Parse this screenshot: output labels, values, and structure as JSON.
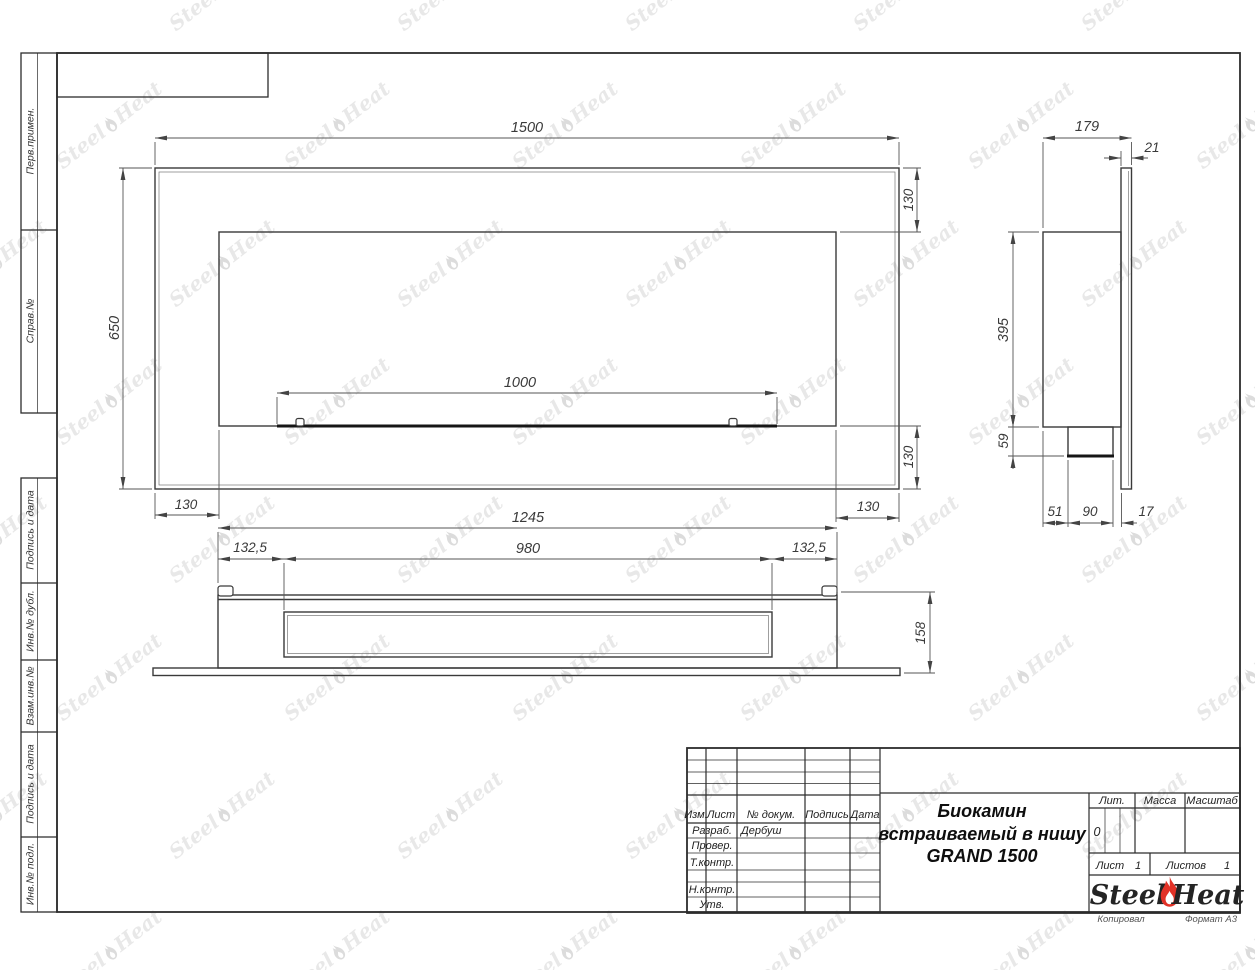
{
  "watermark": {
    "steel": "Steel",
    "heat": "Heat"
  },
  "stamps": {
    "left_column": [
      "Перв.примен.",
      "Справ.№",
      "Подпись и дата",
      "Инв.№ дубл.",
      "Взам.инв.№",
      "Подпись и дата",
      "Инв.№ подл."
    ]
  },
  "views": {
    "front": {
      "width": "1500",
      "height": "650",
      "offset_top": "130",
      "offset_bottom": "130",
      "offset_left": "130",
      "offset_right": "130",
      "burner_width": "1000"
    },
    "side": {
      "depth": "179",
      "panel_thickness": "21",
      "body_height": "395",
      "tray_height": "59",
      "back_offset": "51",
      "tray_depth": "90",
      "front_gap": "17"
    },
    "bottom": {
      "body_width": "1245",
      "slot_width": "980",
      "offset_left": "132,5",
      "offset_right": "132,5",
      "body_depth": "158"
    }
  },
  "title_block": {
    "columns": {
      "izm": "Изм.",
      "list": "Лист",
      "doc": "№ докум.",
      "sign": "Подпись",
      "date": "Дата"
    },
    "rows": {
      "razrab": "Разраб.",
      "razrab_value": "Дербуш",
      "prover": "Провер.",
      "tkontr": "Т.контр.",
      "nkontr": "Н.контр.",
      "utv": "Утв."
    },
    "title_line1": "Биокамин",
    "title_line2": "встраиваемый в нишу",
    "title_line3": "GRAND 1500",
    "lit": "Лит.",
    "lit_value": "0",
    "massa": "Масса",
    "masshtab": "Масштаб",
    "sheet": "Лист",
    "sheet_value": "1",
    "sheets": "Листов",
    "sheets_value": "1",
    "logo_steel": "Steel",
    "logo_heat": "Heat",
    "kopiroval": "Копировал",
    "format": "Формат А3"
  },
  "colors": {
    "accent_red": "#e23227",
    "line": "#3a3a3a",
    "watermark": "#e8e8e8",
    "watermark_mark": "#dcdcdc"
  }
}
